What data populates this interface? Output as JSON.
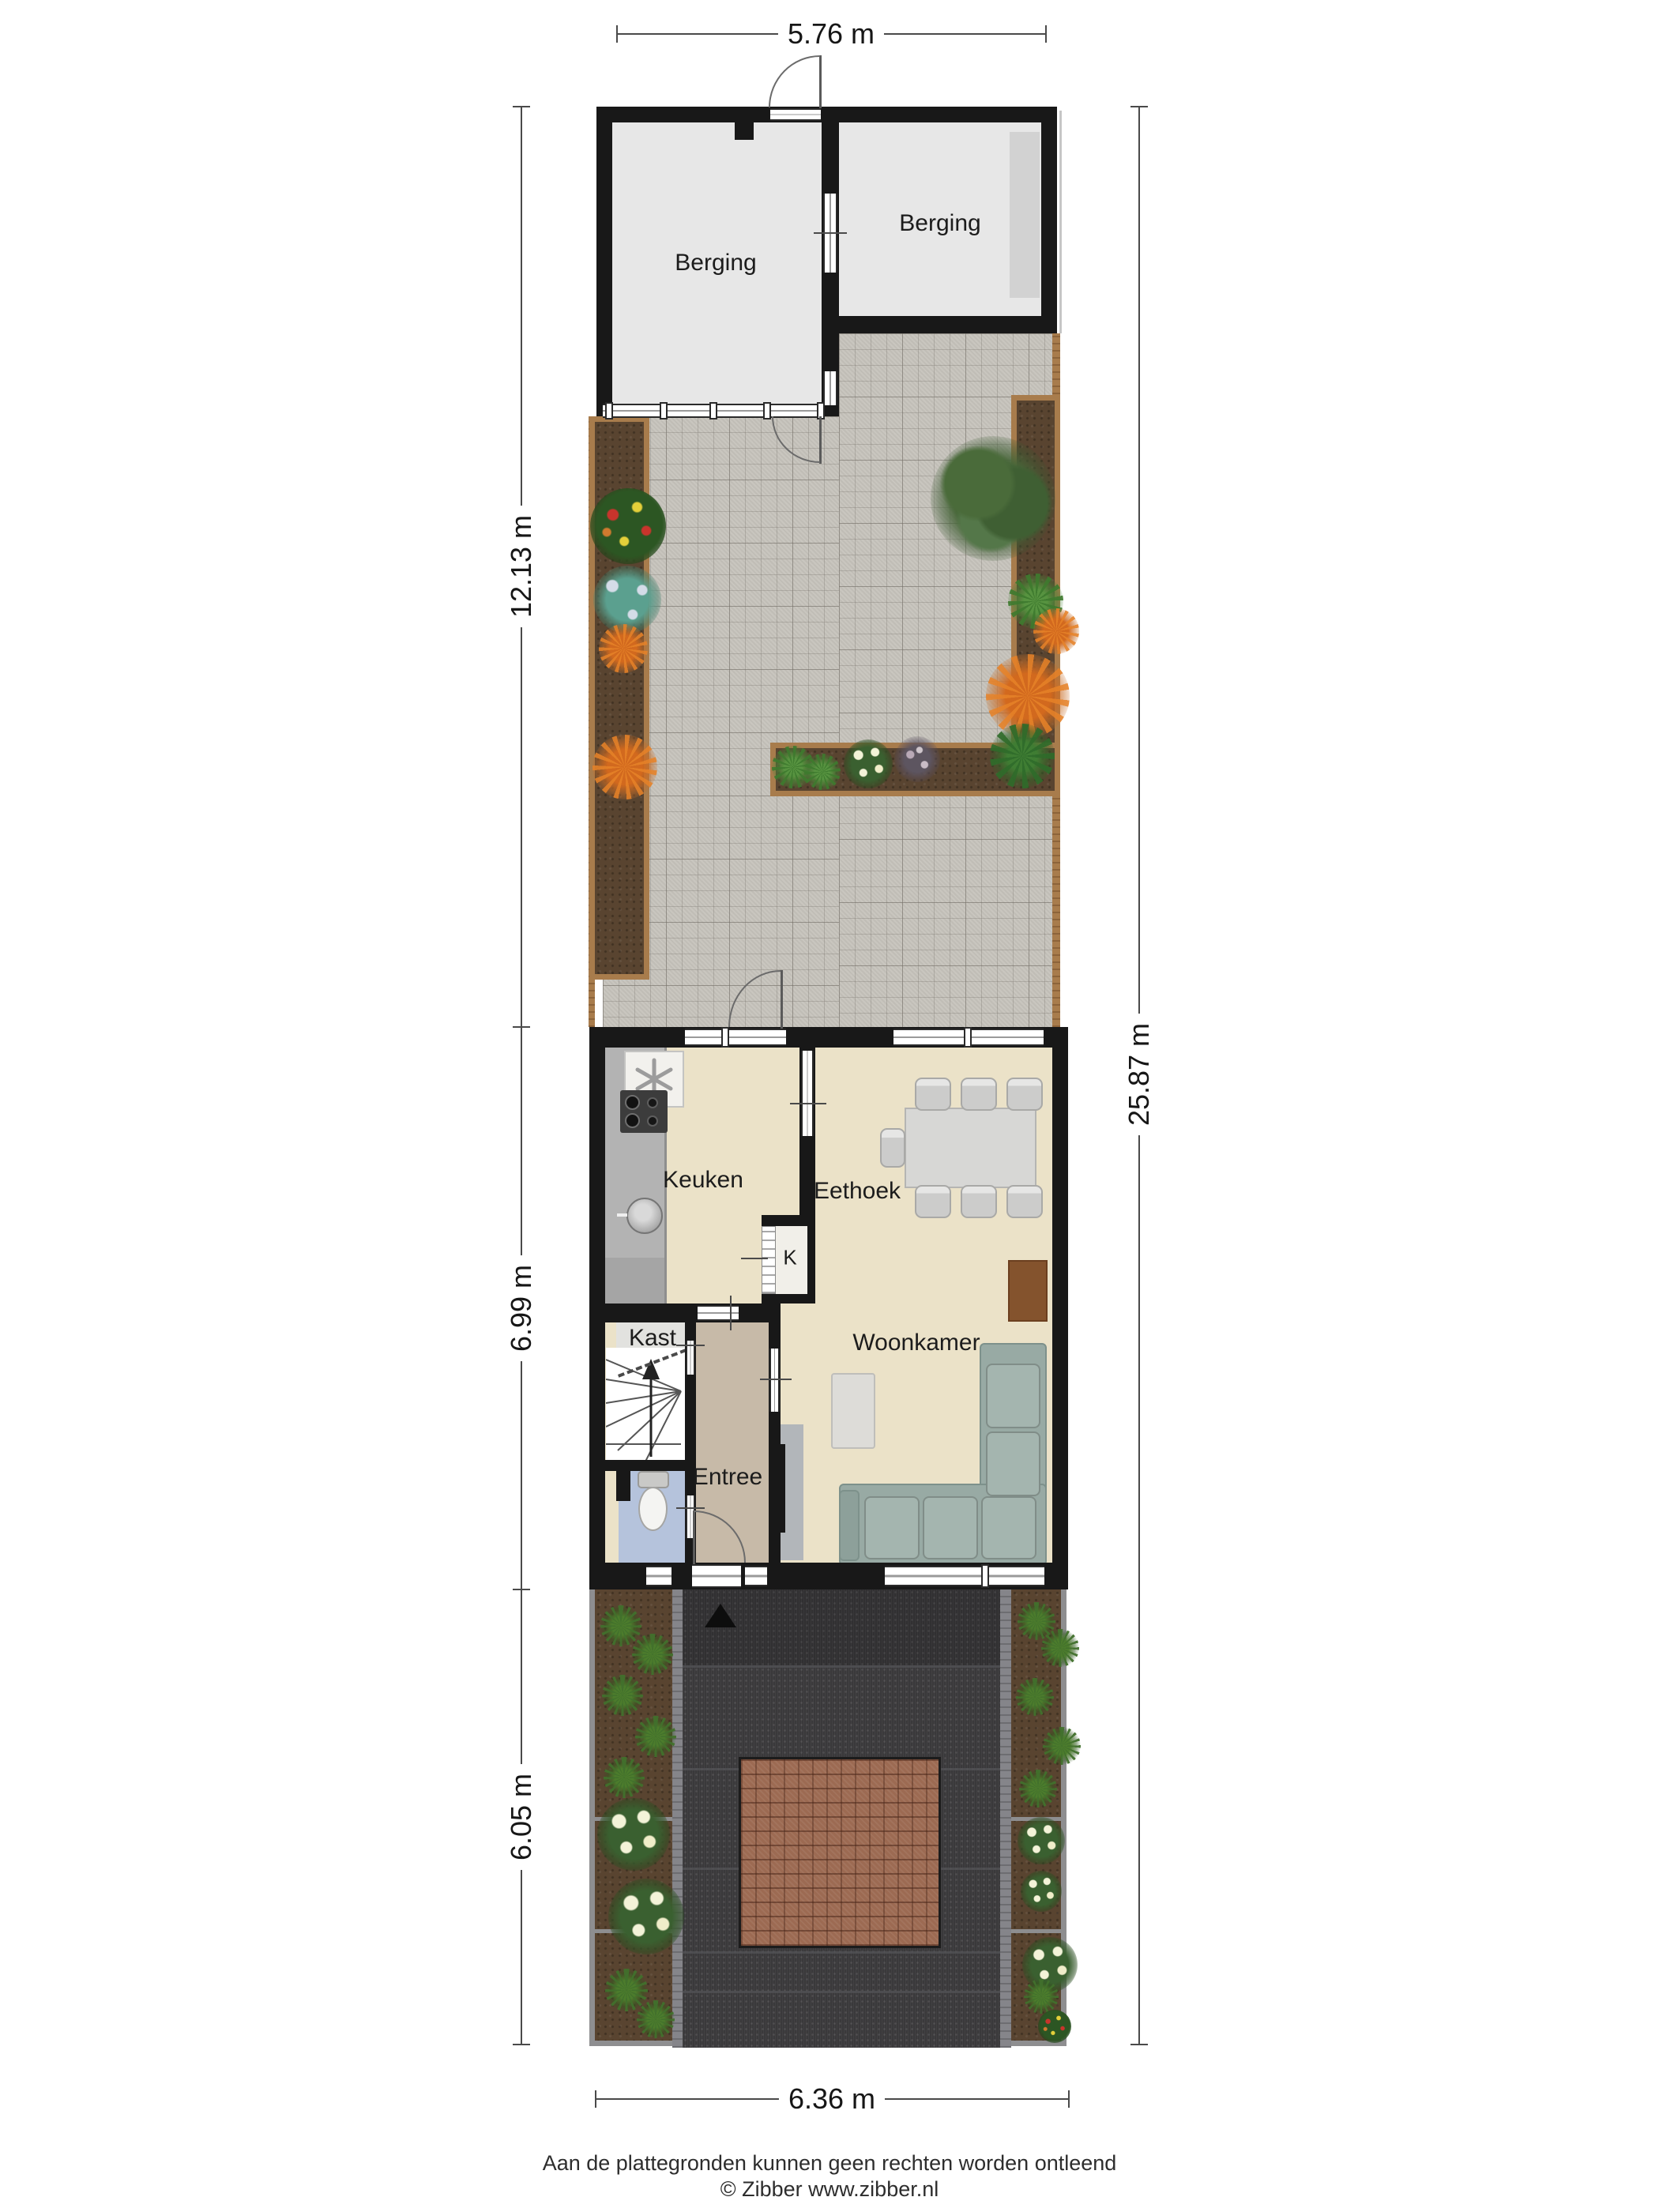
{
  "dimensions": {
    "top_width": "5.76 m",
    "back_garden_depth": "12.13 m",
    "house_depth": "6.99 m",
    "front_garden_depth": "6.05 m",
    "total_depth": "25.87 m",
    "bottom_width": "6.36 m"
  },
  "rooms": {
    "berging_left": "Berging",
    "berging_right": "Berging",
    "keuken": "Keuken",
    "eethoek": "Eethoek",
    "woonkamer": "Woonkamer",
    "kast": "Kast",
    "closet_k": "K",
    "entree": "Entree"
  },
  "footer": {
    "disclaimer": "Aan de plattegronden kunnen geen rechten worden ontleend",
    "credit": "© Zibber www.zibber.nl"
  },
  "colors": {
    "wall": "#181818",
    "house_floor": "#ebe2c8",
    "entree_floor": "#c7baa8",
    "toilet_floor": "#b5c3dc",
    "berging_floor": "#e7e7e7",
    "garden_paving": "#c6c3bc",
    "front_paving": "#3a393b",
    "soil": "#594430",
    "wood": "#a87c4c",
    "brick": "#9c6a52",
    "sofa": "#98aaa4"
  }
}
